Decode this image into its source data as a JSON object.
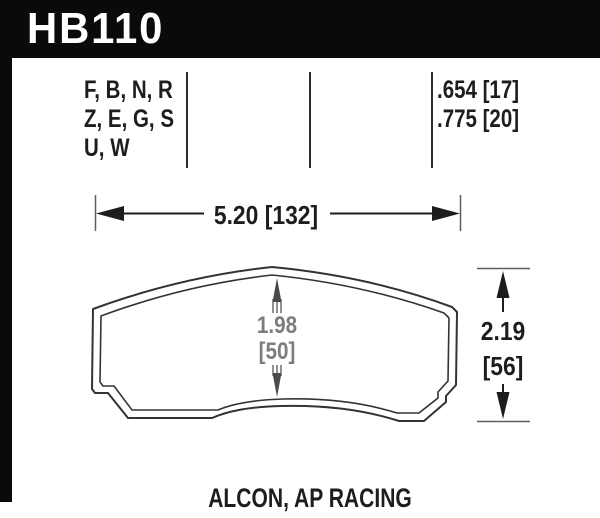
{
  "header": {
    "part_number": "HB110"
  },
  "spec_table": {
    "compound_rows": [
      "F, B, N, R",
      "Z, E, G, S",
      "U, W"
    ],
    "thickness_rows": [
      ".654 [17]",
      ".775 [20]"
    ]
  },
  "dimensions": {
    "width_label": "5.20 [132]",
    "pad_depth": {
      "inches": "1.98",
      "millimeters": "[50]"
    },
    "pad_height": {
      "inches": "2.19",
      "millimeters": "[56]"
    }
  },
  "footer": {
    "applications": "ALCON, AP RACING"
  },
  "colors": {
    "header_bg": "#0a0a0a",
    "ink": "#1d1d1d",
    "dim_text_gray": "#7d7d7d",
    "outline": "#333333",
    "tick_gray": "#5e5e5e"
  }
}
